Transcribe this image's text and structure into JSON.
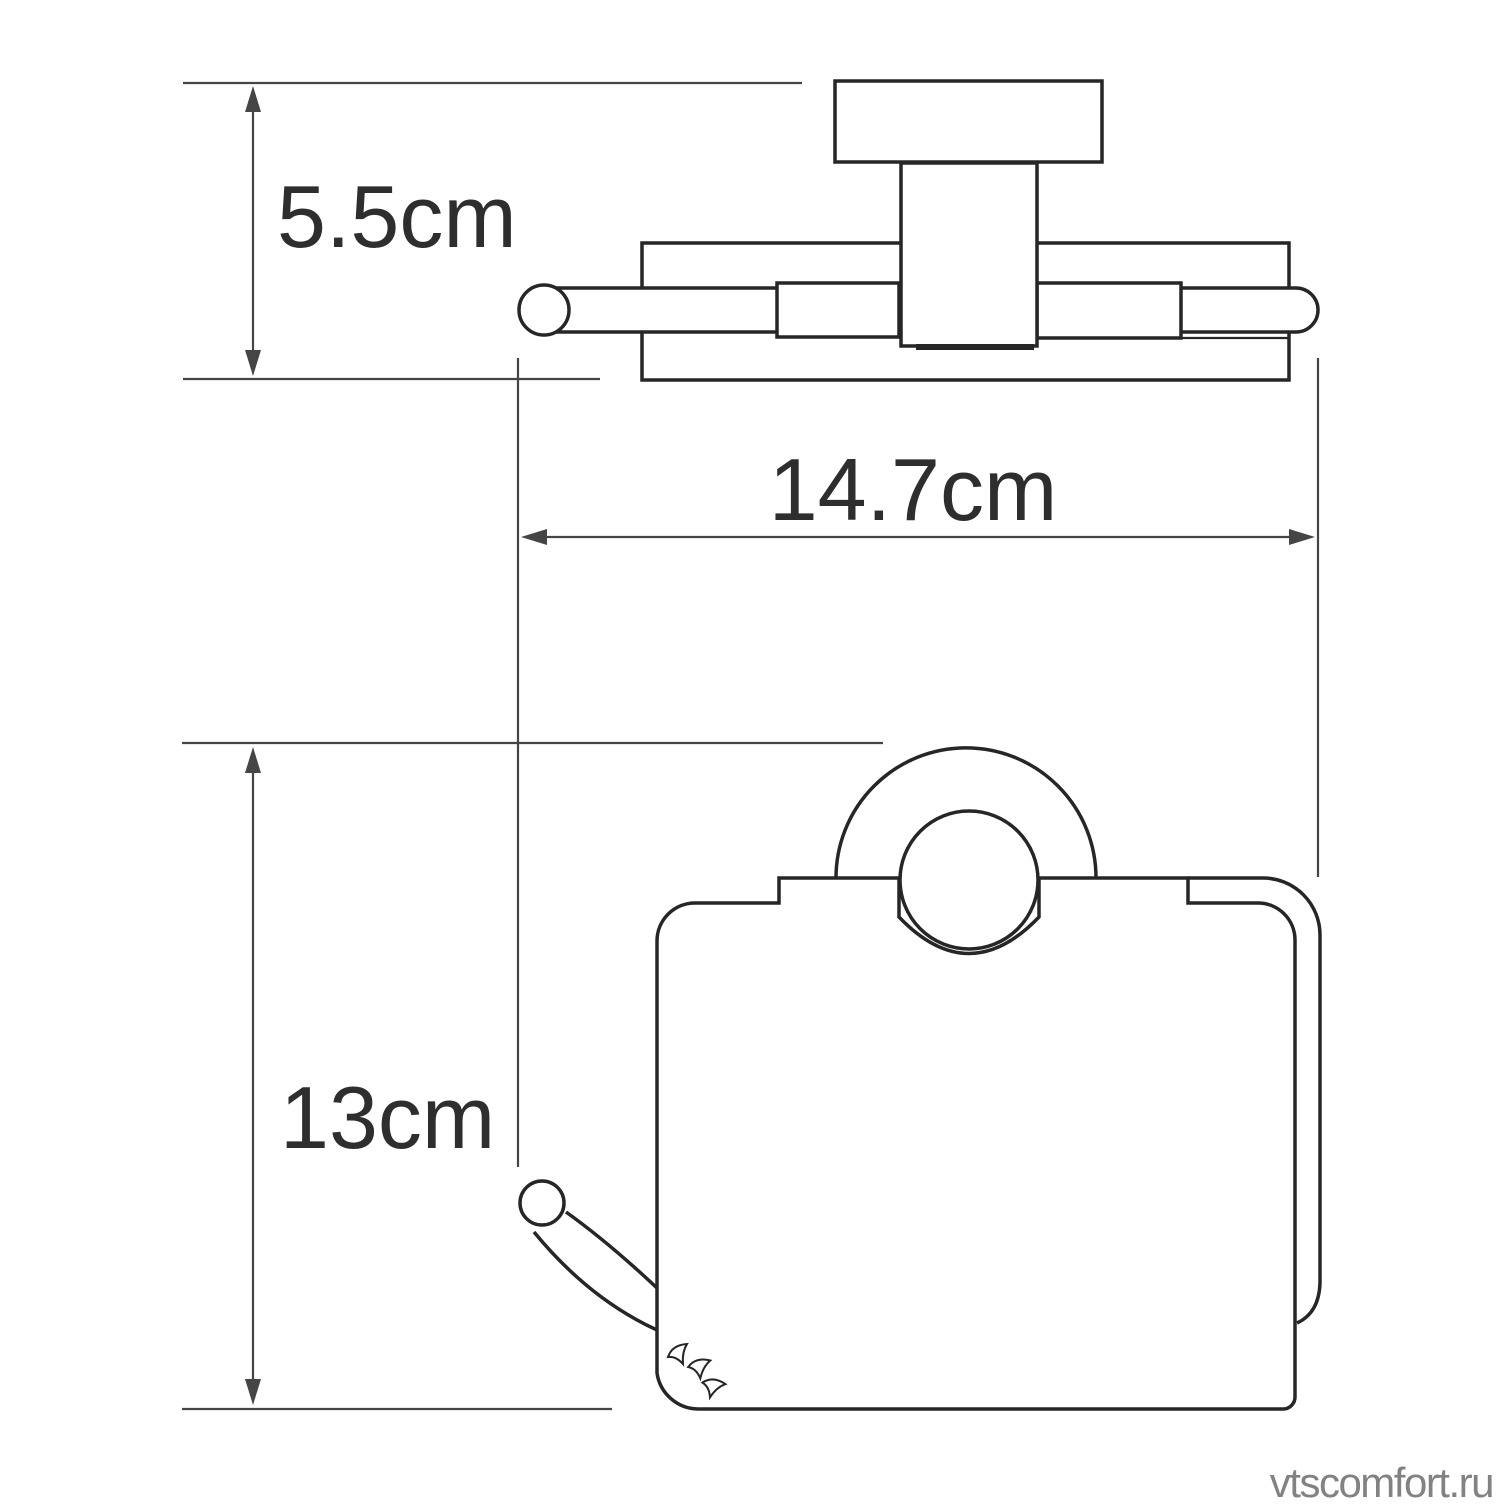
{
  "page": {
    "background": "#ffffff"
  },
  "colors": {
    "outline": "#262626",
    "thin_line": "#2d2d2d",
    "dimension": "#454545",
    "label": "#2e2e2e",
    "watermark": "#828282"
  },
  "diagram": {
    "type": "technical-dimension-drawing",
    "subject": "wall-mounted covered toilet paper holder, two orthographic views",
    "views": [
      {
        "name": "top-view",
        "description": "holder seen from above: wall block, stem, mounting plate and roller bar"
      },
      {
        "name": "front-view",
        "description": "holder seen from front: cover with mounting ring, roller knob, spare hook and torn-paper marks"
      }
    ],
    "dimensions": [
      {
        "id": "depth",
        "label": "5.5cm",
        "value": 5.5,
        "unit": "cm",
        "orientation": "vertical",
        "applies_to": "top-view depth"
      },
      {
        "id": "width",
        "label": "14.7cm",
        "value": 14.7,
        "unit": "cm",
        "orientation": "horizontal",
        "applies_to": "overall width"
      },
      {
        "id": "height",
        "label": "13cm",
        "value": 13,
        "unit": "cm",
        "orientation": "vertical",
        "applies_to": "front-view height"
      }
    ],
    "watermark": "vtscomfort.ru"
  }
}
